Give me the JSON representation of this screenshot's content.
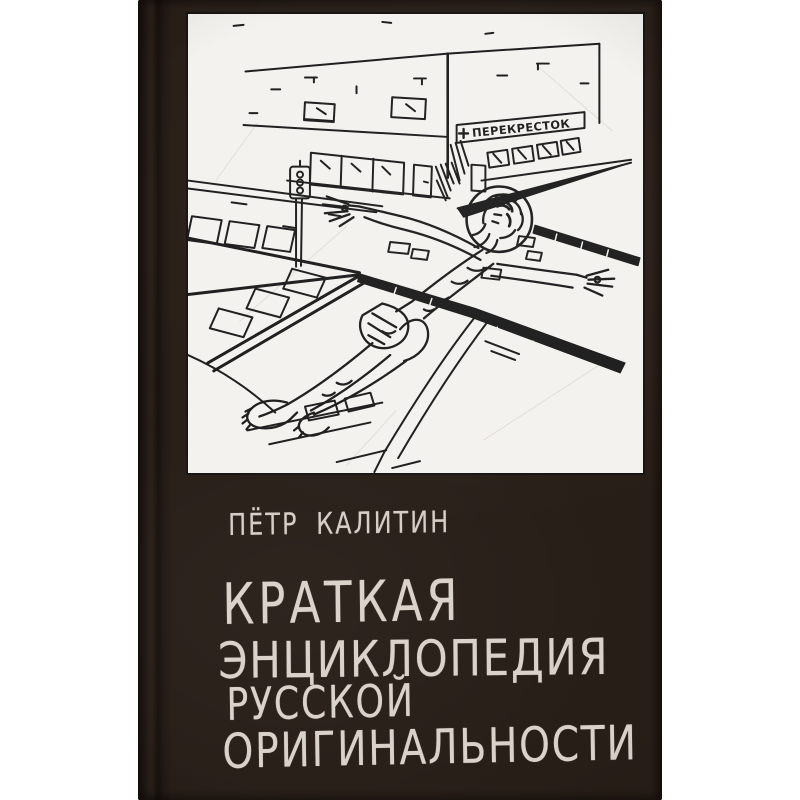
{
  "page": {
    "background_color": "#ffffff"
  },
  "book": {
    "cover_color": "#281e18",
    "author_line": "ПЁТР КАЛИТИН",
    "title_lines": [
      "КРАТКАЯ",
      "ЭНЦИКЛОПЕДИЯ",
      "РУССКОЙ",
      "ОРИГИНАЛЬНОСТИ"
    ],
    "text_color": "#d8d2c9"
  },
  "illustration": {
    "paper_color": "#f3f2ee",
    "ink_color": "#1c1c1c",
    "storefront_sign": "ПЕРЕКРЕСТОК"
  }
}
